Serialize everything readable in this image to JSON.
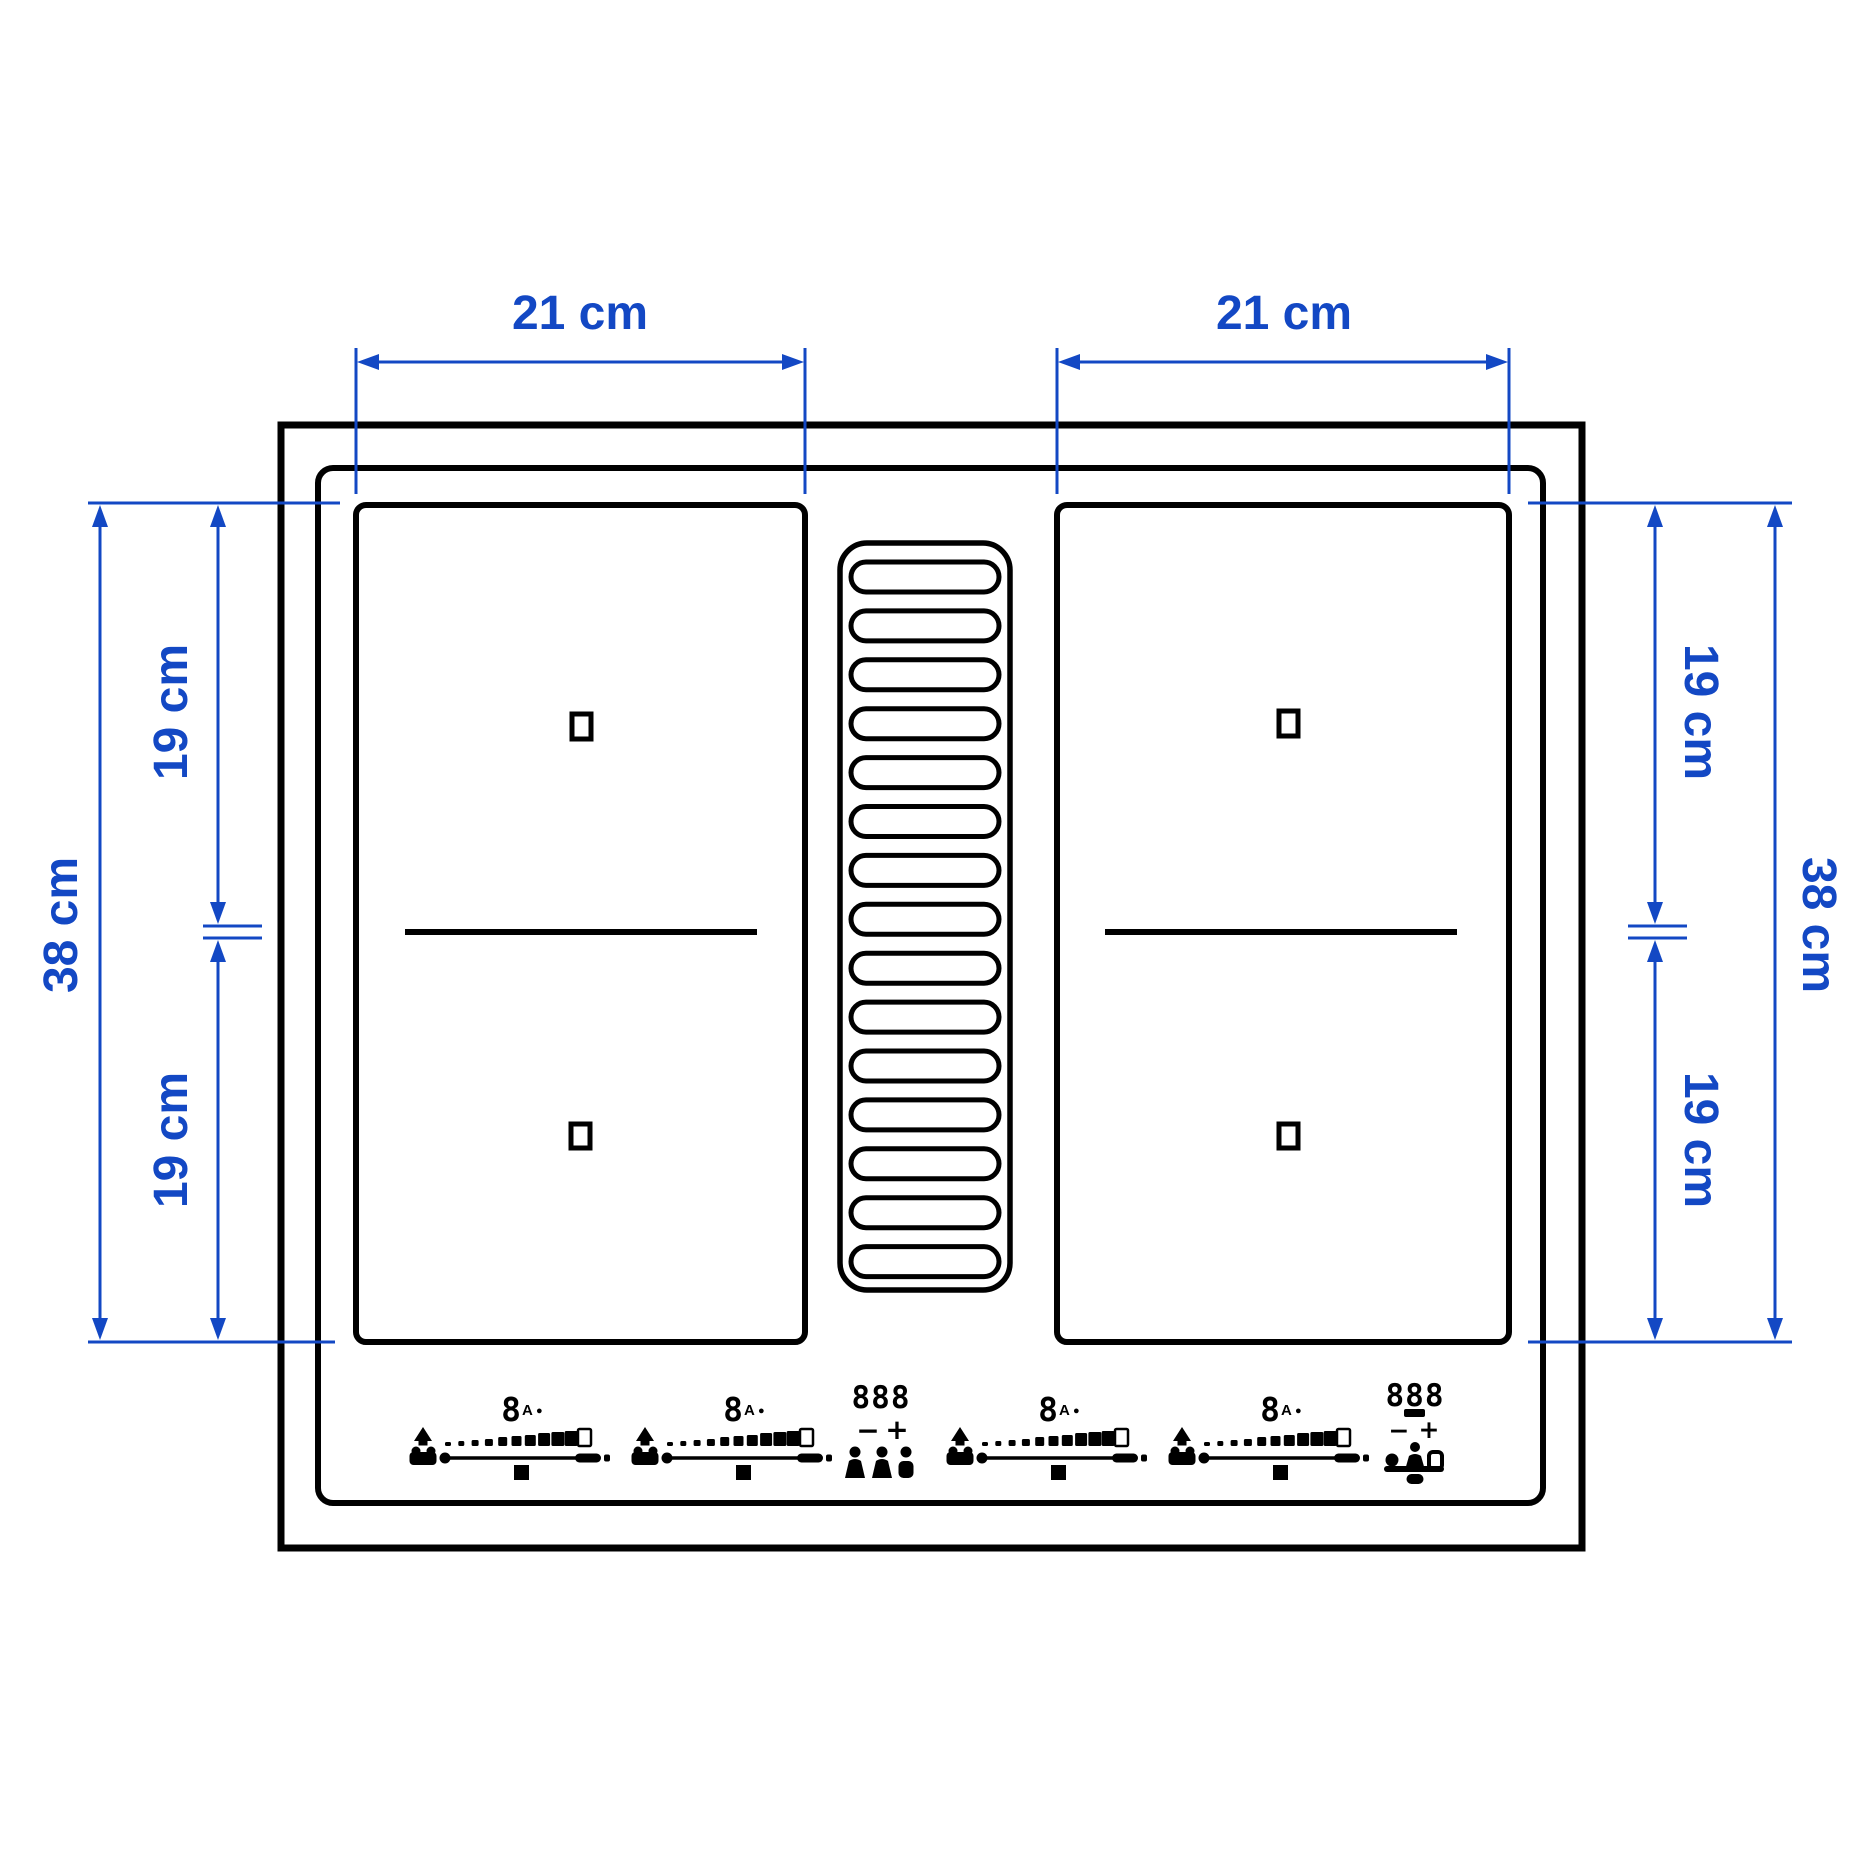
{
  "colors": {
    "dimension_blue": "#1348c4",
    "line_black": "#000000",
    "background": "#ffffff"
  },
  "dimensions": {
    "top_left_width": "21 cm",
    "top_right_width": "21 cm",
    "left_height_total": "38 cm",
    "left_height_upper": "19 cm",
    "left_height_lower": "19 cm",
    "right_height_upper": "19 cm",
    "right_height_lower": "19 cm",
    "right_height_total": "38 cm"
  },
  "vent": {
    "slot_count": 15
  },
  "controls": {
    "zone_groups": [
      {
        "x": 423,
        "power_display": "8",
        "mode_indicator": "A",
        "status_dot": "●"
      },
      {
        "x": 645,
        "power_display": "8",
        "mode_indicator": "A",
        "status_dot": "●"
      },
      {
        "x": 960,
        "power_display": "8",
        "mode_indicator": "A",
        "status_dot": "●"
      },
      {
        "x": 1182,
        "power_display": "8",
        "mode_indicator": "A",
        "status_dot": "●"
      }
    ],
    "hood_center": {
      "display": "888",
      "minus": "−",
      "plus": "+"
    },
    "hood_right": {
      "display": "888",
      "minus": "−",
      "plus": "+"
    }
  }
}
